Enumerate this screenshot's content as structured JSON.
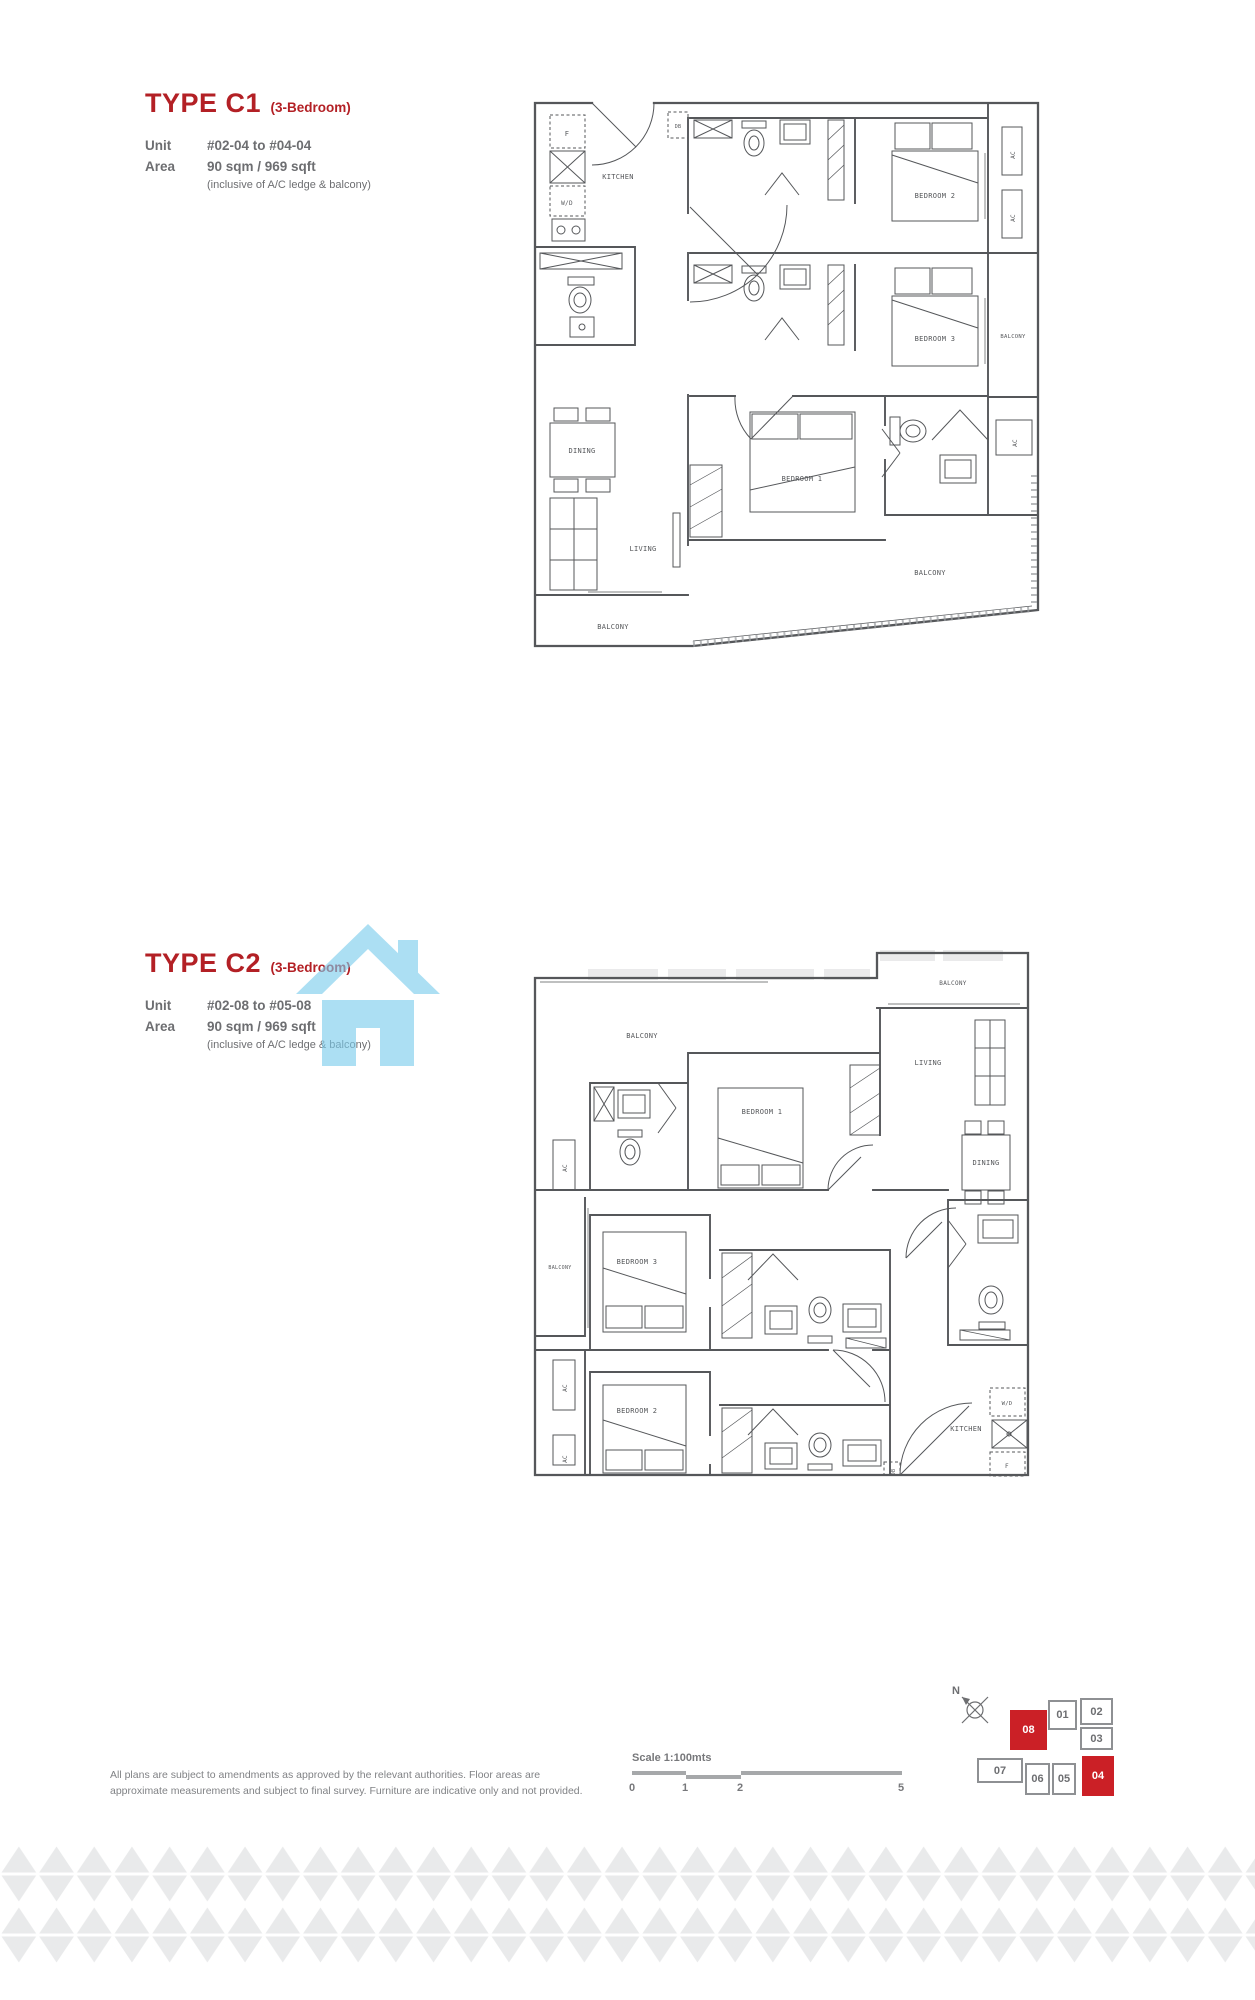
{
  "colors": {
    "accent_red": "#b32025",
    "keyplan_red": "#cb2026",
    "watermark_blue": "#7accec",
    "plan_line": "#55575a",
    "text_gray": "#77787b",
    "text_gray_dark": "#6d6e71",
    "pattern_gray": "#e9eaeb",
    "scalebar_gray": "#a6a8aa"
  },
  "units": [
    {
      "title": "TYPE C1",
      "subtitle": "(3-Bedroom)",
      "unit_label": "Unit",
      "unit_value": "#02-04 to #04-04",
      "area_label": "Area",
      "area_value": "90 sqm / 969 sqft",
      "area_note": "(inclusive of A/C ledge & balcony)"
    },
    {
      "title": "TYPE C2",
      "subtitle": "(3-Bedroom)",
      "unit_label": "Unit",
      "unit_value": "#02-08 to #05-08",
      "area_label": "Area",
      "area_value": "90 sqm / 969 sqft",
      "area_note": "(inclusive of A/C ledge & balcony)"
    }
  ],
  "plan_labels": {
    "kitchen": "KITCHEN",
    "fridge": "F",
    "washer_dryer": "W/D",
    "db": "DB",
    "bedroom1": "BEDROOM 1",
    "bedroom2": "BEDROOM 2",
    "bedroom3": "BEDROOM 3",
    "dining": "DINING",
    "living": "LIVING",
    "balcony": "BALCONY",
    "ac": "AC"
  },
  "key_plan": {
    "north_label": "N",
    "units": [
      {
        "id": "08",
        "highlighted": true
      },
      {
        "id": "01",
        "highlighted": false
      },
      {
        "id": "02",
        "highlighted": false
      },
      {
        "id": "03",
        "highlighted": false
      },
      {
        "id": "07",
        "highlighted": false
      },
      {
        "id": "06",
        "highlighted": false
      },
      {
        "id": "05",
        "highlighted": false
      },
      {
        "id": "04",
        "highlighted": true
      }
    ]
  },
  "footer": {
    "disclaimer": "All plans are subject to amendments as approved by the relevant authorities. Floor areas are approximate measurements and subject to final survey. Furniture are indicative only and not provided.",
    "scale": {
      "label": "Scale 1:100mts",
      "ticks": [
        "0",
        "1",
        "2",
        "5"
      ]
    }
  }
}
